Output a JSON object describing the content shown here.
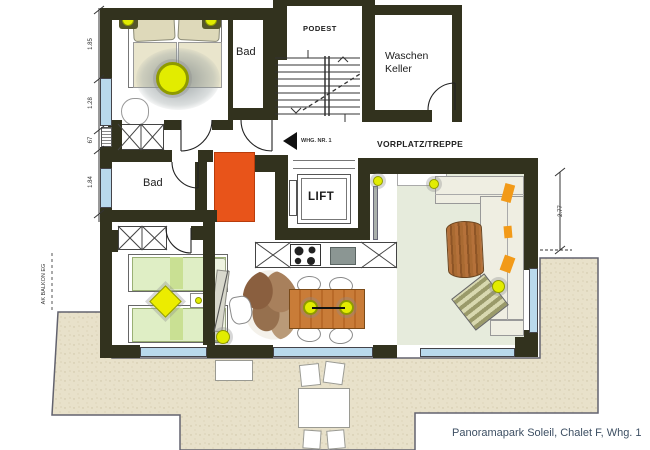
{
  "caption": "Panoramapark Soleil, Chalet F, Whg. 1",
  "rooms": {
    "bad_top": "Bad",
    "bad_mid": "Bad",
    "podest": "PODEST",
    "waschen_line1": "Waschen",
    "waschen_line2": "Keller",
    "lift": "LIFT",
    "vorplatz": "VORPLATZ/TREPPE"
  },
  "annotations": {
    "entry": "WHG. NR. 1",
    "balkon_marker": "AK BALKON EG"
  },
  "dimensions": {
    "left": [
      "1.85",
      "1.28",
      "67",
      "1.84"
    ],
    "right": [
      "2.77"
    ]
  },
  "colors": {
    "wall": "#32321e",
    "window_blue": "#b9d9ec",
    "balcony_floor": "#e8e1ca",
    "living_floor": "#e6ebdc",
    "bed_green": "#dfeec5",
    "cabinet_orange": "#e8541a",
    "light_yellow": "#e2ec00",
    "wood_brown": "#c07a3a",
    "caption_text": "#3d4f63"
  }
}
